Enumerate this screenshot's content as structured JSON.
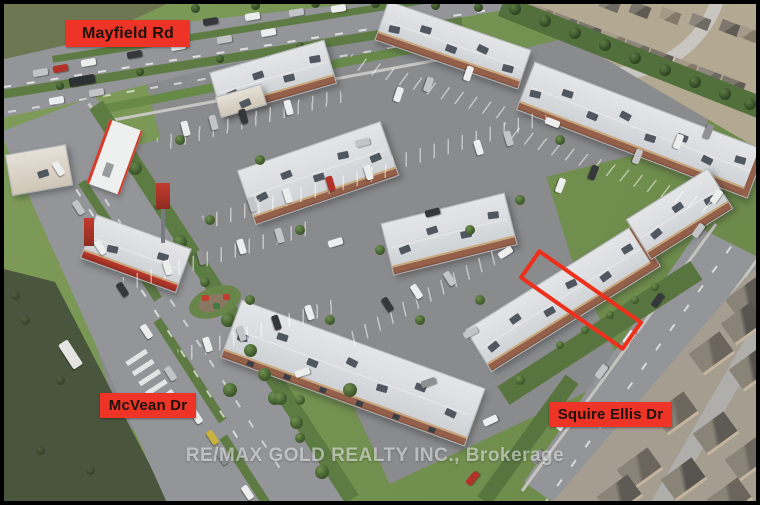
{
  "roads": [
    {
      "id": "mayfield-rd",
      "label": "Mayfield Rd"
    },
    {
      "id": "mcvean-dr",
      "label": "McVean Dr"
    },
    {
      "id": "squire-ellis-dr",
      "label": "Squire Ellis Dr"
    }
  ],
  "watermark": {
    "text": "RE/MAX GOLD REALTY INC., Brokerage"
  },
  "highlight": {
    "label": "highlighted-unit-outline",
    "color": "#ee2f1c"
  },
  "colors": {
    "label_bg": "#ee3426",
    "label_text": "#1d120c",
    "road": "#949598",
    "parking": "#8a8b8d",
    "grass": "#7b9755",
    "dark_field": "#4a553d",
    "roof": "#dcdee1",
    "brick": "#95604a",
    "residential_base": "#b3a892",
    "watermark_text": "rgba(250,250,250,0.55)"
  }
}
